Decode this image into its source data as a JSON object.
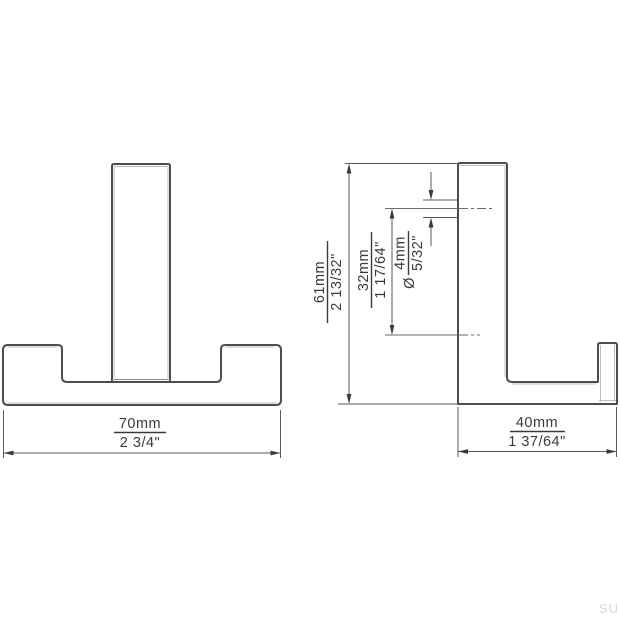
{
  "watermark": "SU",
  "colors": {
    "background": "#ffffff",
    "outline": "#4d4d4d",
    "dimension_lines": "#5a5a5a",
    "text": "#3a3a3a",
    "light_edge": "#bcbcbc",
    "watermark": "#d9d9d9"
  },
  "views": {
    "front": {
      "label": "front-view-double-hook",
      "width_dim": {
        "mm": "70mm",
        "inch": "2 3/4\""
      }
    },
    "side": {
      "label": "side-view-double-hook",
      "width_dim": {
        "mm": "40mm",
        "inch": "1 37/64\""
      },
      "height_dim": {
        "mm": "61mm",
        "inch": "2 13/32\""
      },
      "hole_offset_dim": {
        "mm": "32mm",
        "inch": "1 17/64\""
      },
      "hole_dia_dim": {
        "symbol": "Ø",
        "mm": "4mm",
        "inch": "5/32\""
      }
    }
  }
}
